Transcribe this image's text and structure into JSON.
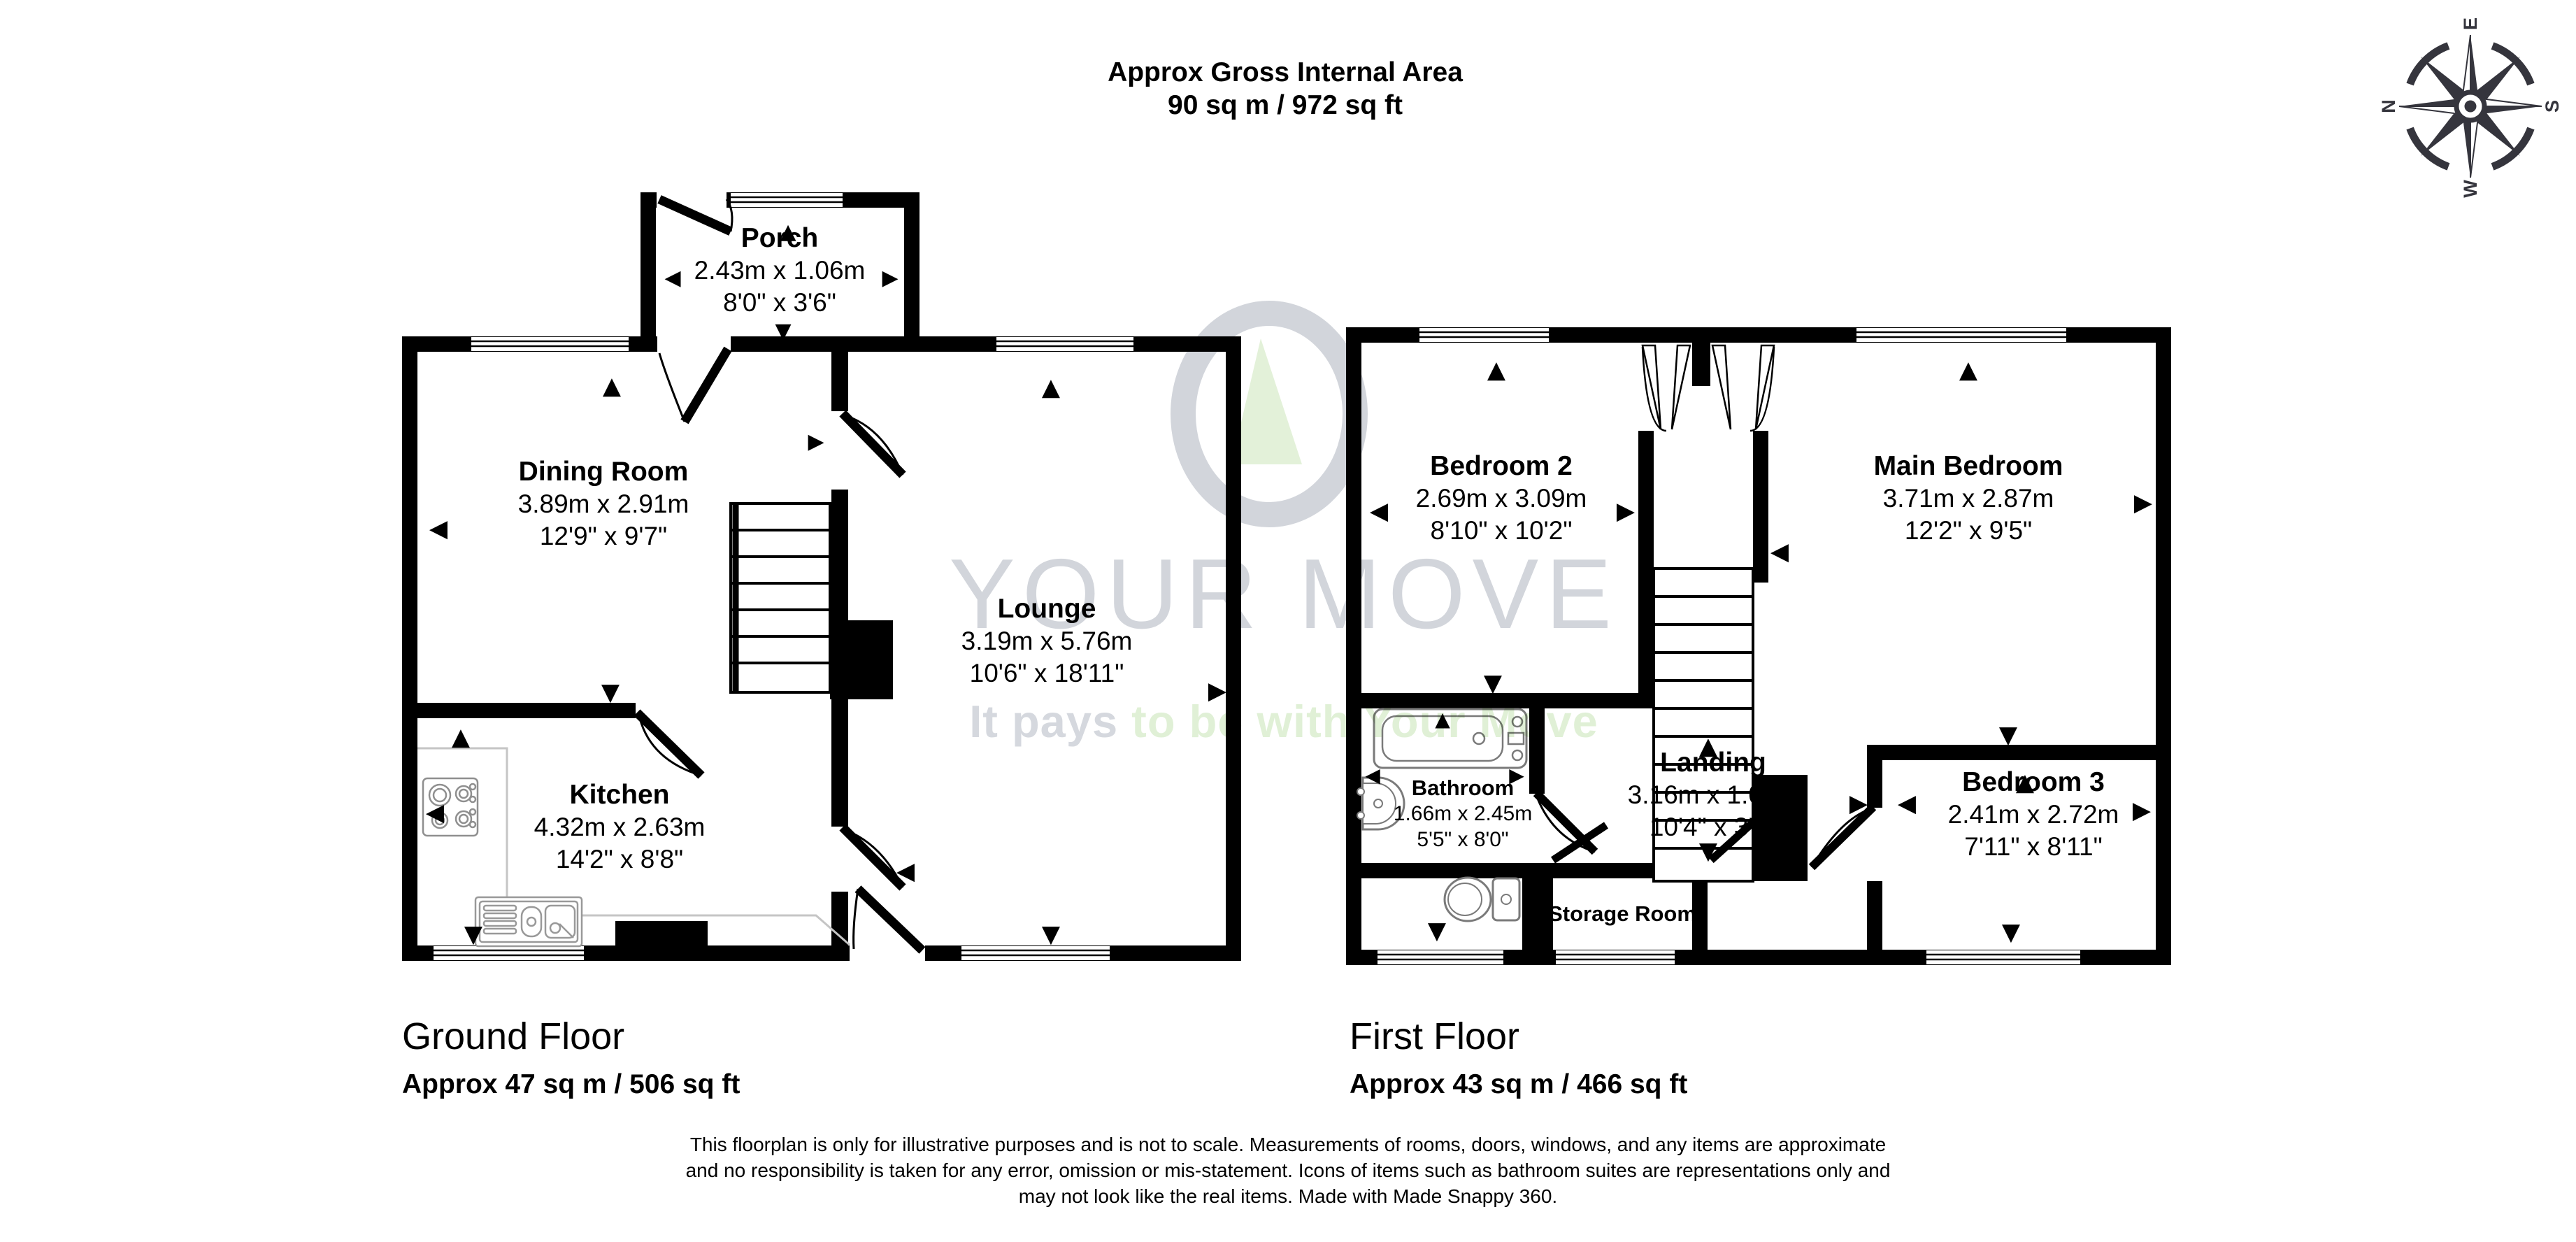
{
  "header": {
    "title_line1": "Approx Gross Internal Area",
    "title_line2": "90 sq m / 972 sq ft"
  },
  "compass": {
    "n": "N",
    "e": "E",
    "s": "S",
    "w": "W"
  },
  "watermark": {
    "brand": "YOUR MOVE",
    "tagline_gray": "It pays ",
    "tagline_green": "to be with Your Move",
    "gray_color": "#d2d5db",
    "green_color": "#e0f0d6"
  },
  "ground_floor": {
    "label": "Ground Floor",
    "area": "Approx 47 sq m / 506 sq ft",
    "rooms": [
      {
        "name": "Porch",
        "metric": "2.43m x 1.06m",
        "imperial": "8'0\" x 3'6\""
      },
      {
        "name": "Dining Room",
        "metric": "3.89m x 2.91m",
        "imperial": "12'9\" x 9'7\""
      },
      {
        "name": "Lounge",
        "metric": "3.19m x 5.76m",
        "imperial": "10'6\" x 18'11\""
      },
      {
        "name": "Kitchen",
        "metric": "4.32m x 2.63m",
        "imperial": "14'2\" x 8'8\""
      }
    ]
  },
  "first_floor": {
    "label": "First Floor",
    "area": "Approx 43 sq m / 466 sq ft",
    "rooms": [
      {
        "name": "Bedroom 2",
        "metric": "2.69m x 3.09m",
        "imperial": "8'10\" x 10'2\""
      },
      {
        "name": "Main Bedroom",
        "metric": "3.71m x 2.87m",
        "imperial": "12'2\" x 9'5\""
      },
      {
        "name": "Bathroom",
        "metric": "1.66m x 2.45m",
        "imperial": "5'5\" x 8'0\""
      },
      {
        "name": "Landing",
        "metric": "3.16m x 1.05m",
        "imperial": "10'4\" x 3'5\""
      },
      {
        "name": "Bedroom 3",
        "metric": "2.41m x 2.72m",
        "imperial": "7'11\" x 8'11\""
      },
      {
        "name": "Storage Room"
      }
    ]
  },
  "footer": {
    "disclaimer_line1": "This floorplan is only for illustrative purposes and is not to scale. Measurements of rooms, doors, windows, and any items are approximate",
    "disclaimer_line2": "and no responsibility is taken for any error, omission or mis-statement. Icons of items such as bathroom suites are representations only and",
    "disclaimer_line3": "may not look like the real items. Made with Made Snappy 360."
  }
}
